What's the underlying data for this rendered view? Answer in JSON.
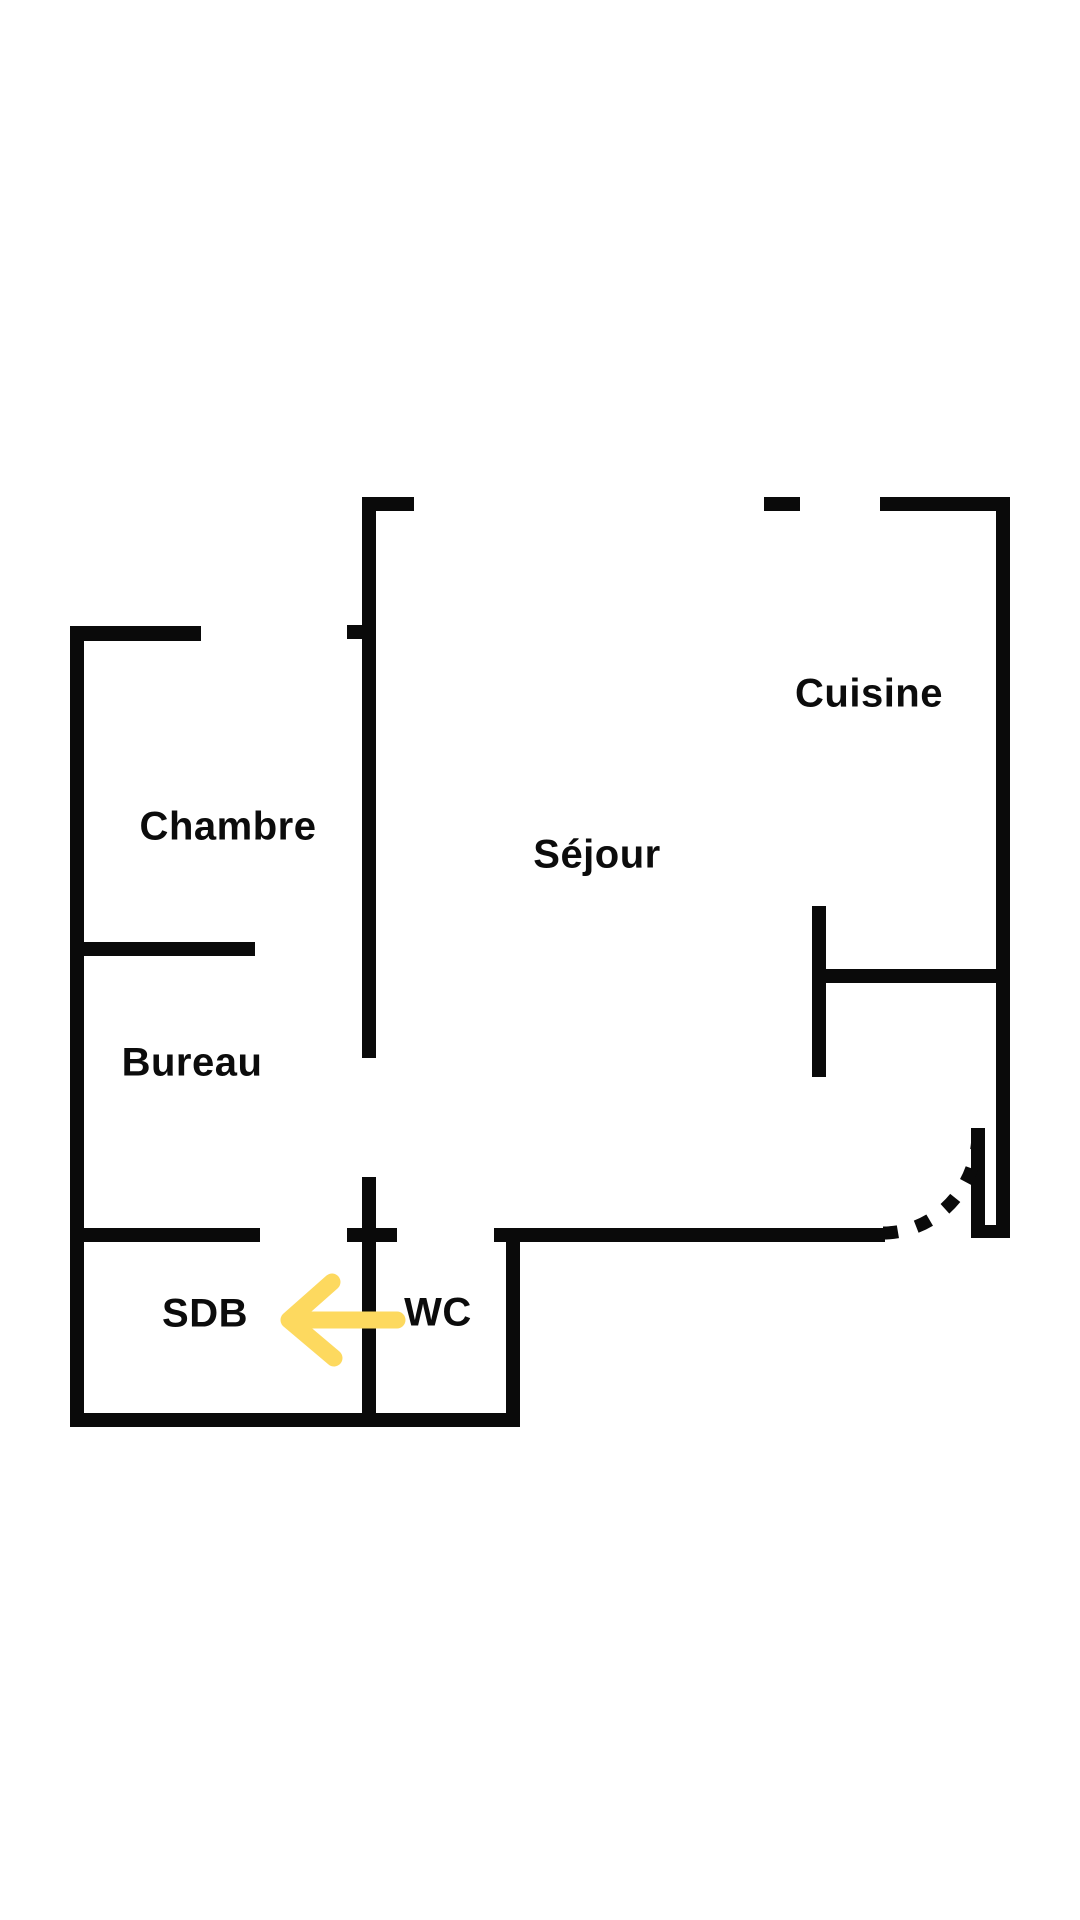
{
  "floor_plan": {
    "rooms": {
      "cuisine": {
        "label": "Cuisine"
      },
      "chambre": {
        "label": "Chambre"
      },
      "sejour": {
        "label": "Séjour"
      },
      "bureau": {
        "label": "Bureau"
      },
      "sdb": {
        "label": "SDB"
      },
      "wc": {
        "label": "WC"
      }
    },
    "colors": {
      "wall": "#0a0a0a",
      "background": "#ffffff",
      "arrow": "#FDD95F"
    },
    "annotations": {
      "direction_arrow": {
        "shape": "left-arrow",
        "color": "#FDD95F",
        "location": "between WC and SDB"
      },
      "door_swing": {
        "style": "dashed-quarter-arc",
        "location": "entrance opening, bottom right of Séjour"
      }
    }
  }
}
